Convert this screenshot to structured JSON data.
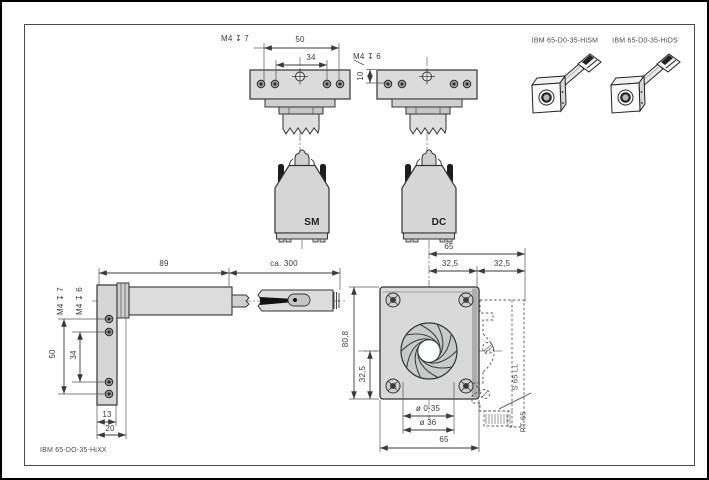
{
  "drawing": {
    "models": {
      "hism_label": "IBM 65-D0-35-HiSM",
      "hids_label": "IBM 65-D0-35-HiDS",
      "footer_label": "IBM 65-DO-35-HiXX"
    },
    "connectors": {
      "sm": "SM",
      "dc": "DC"
    },
    "rail_labels": {
      "s65ll": "S 65 LL",
      "rt65": "RT 65"
    },
    "dims": {
      "top_view": {
        "thread_depth_7": "M4 ↧ 7",
        "hole_pitch_50": "50",
        "hole_pitch_34": "34",
        "thread_depth_6": "M4 ↧ 6",
        "edge_offset_10": "10"
      },
      "side_view": {
        "body_length_89": "89",
        "cable_length": "ca. 300",
        "thread_depth_7": "M4 ↧ 7",
        "thread_depth_6": "M4 ↧ 6",
        "hole_pitch_50": "50",
        "hole_pitch_34": "34",
        "plate_thickness_13": "13",
        "overall_depth_20": "20"
      },
      "front_view": {
        "rail_distance_65": "65",
        "half_left_325": "32,5",
        "half_right_325": "32,5",
        "plate_height_808": "80,8",
        "center_height_325": "32,5",
        "aperture_range": "ø 0-35",
        "bore_diameter": "ø 36",
        "plate_width_65": "65"
      }
    },
    "colors": {
      "background": "#ffffff",
      "line": "#3a3a3a",
      "fill_light": "#dadada",
      "fill_mid": "#c9c9c9",
      "text": "#3a3a3a",
      "frame": "#4a4a4a"
    }
  }
}
